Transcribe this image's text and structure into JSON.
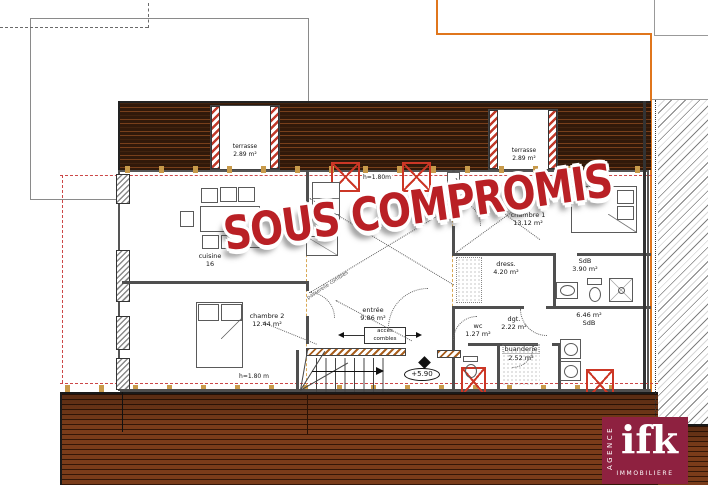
{
  "watermark": {
    "text": "SOUS COMPROMIS"
  },
  "rooms": [
    {
      "name": "terrasse",
      "area": "2.89 m²"
    },
    {
      "name": "terrasse",
      "area": "2.89 m²"
    },
    {
      "name": "cuisine",
      "area": "16"
    },
    {
      "name": "chambre 1",
      "area": "13.12 m²"
    },
    {
      "name": "chambre 2",
      "area": "12.44 m²"
    },
    {
      "name": "dress.",
      "area": "4.20 m²"
    },
    {
      "name": "SdB",
      "area": "3.90 m²"
    },
    {
      "name": "entrée",
      "area": "9.86 m²"
    },
    {
      "name": "dgt.",
      "area": "2.22 m²"
    },
    {
      "name": "wc",
      "area": "1.27 m²"
    },
    {
      "name": "buanderie",
      "area": "2.52 m²"
    },
    {
      "name": "SdB",
      "area": "6.46 m²"
    }
  ],
  "annotations": {
    "height_limit_top": "h=1.80m",
    "height_limit_bottom": "h=1.80 m",
    "level_marker": "+5.90",
    "attic_access_line1": "accès",
    "attic_access_line2": "combles",
    "walkway": "passerelle combles"
  },
  "logo": {
    "vertical_text": "AGENCE",
    "brand": "ifk",
    "bottom_text": "IMMOBILIERE"
  },
  "colors": {
    "watermark_red": "#b92025",
    "logo_maroon": "#8e2140",
    "skylight_red": "#cc3726",
    "roof_dark_brown": "#31190a",
    "deck_brown": "#7a3c1a",
    "boundary_orange": "#e0761c",
    "axis_red": "#cc4747",
    "axis_tan": "#d8a855"
  }
}
